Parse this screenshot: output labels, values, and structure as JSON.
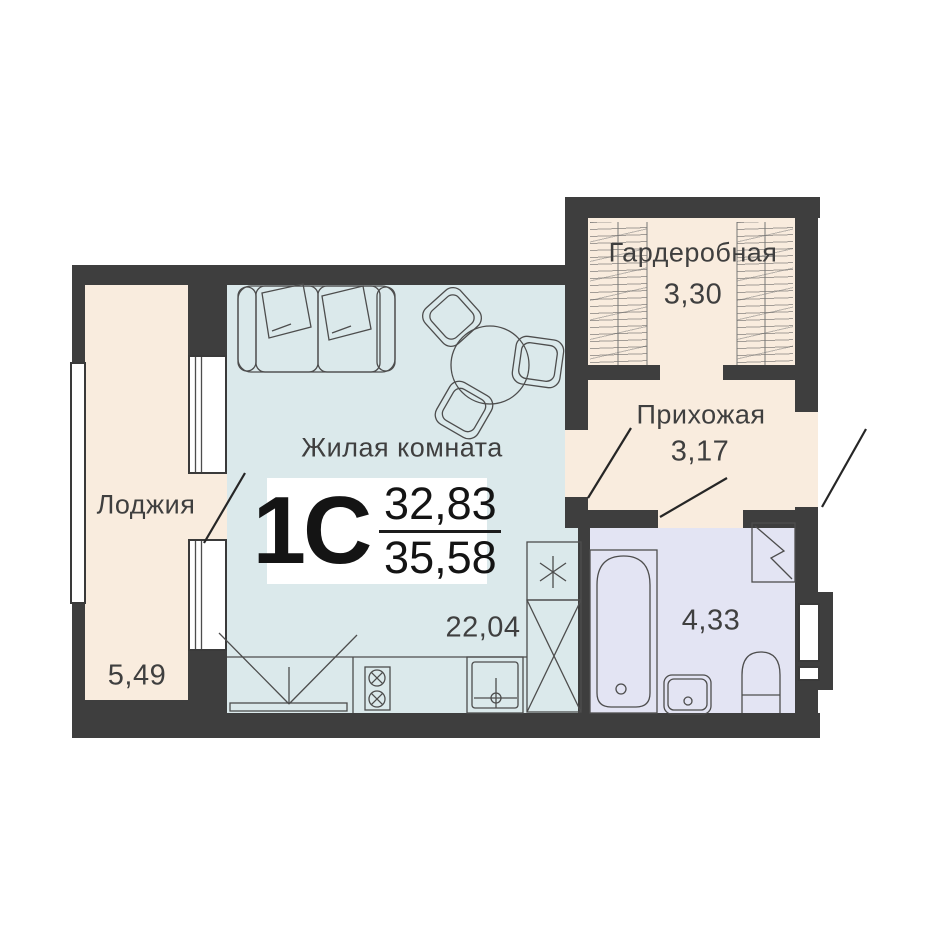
{
  "plan": {
    "type_code": "1С",
    "living_area": "32,83",
    "total_area": "35,58"
  },
  "rooms": {
    "living": {
      "name": "Жилая комната",
      "area": "22,04"
    },
    "loggia": {
      "name": "Лоджия",
      "area": "5,49"
    },
    "wardrobe": {
      "name": "Гардеробная",
      "area": "3,30"
    },
    "hallway": {
      "name": "Прихожая",
      "area": "3,17"
    },
    "bathroom": {
      "area": "4,33"
    }
  },
  "colors": {
    "wall": "#3e3e3e",
    "warm": "#f9ecde",
    "living": "#dbe9eb",
    "bath": "#e3e4f3",
    "line": "#4d4d4d",
    "ink": "#3f3f3f",
    "paper": "#ffffff"
  }
}
